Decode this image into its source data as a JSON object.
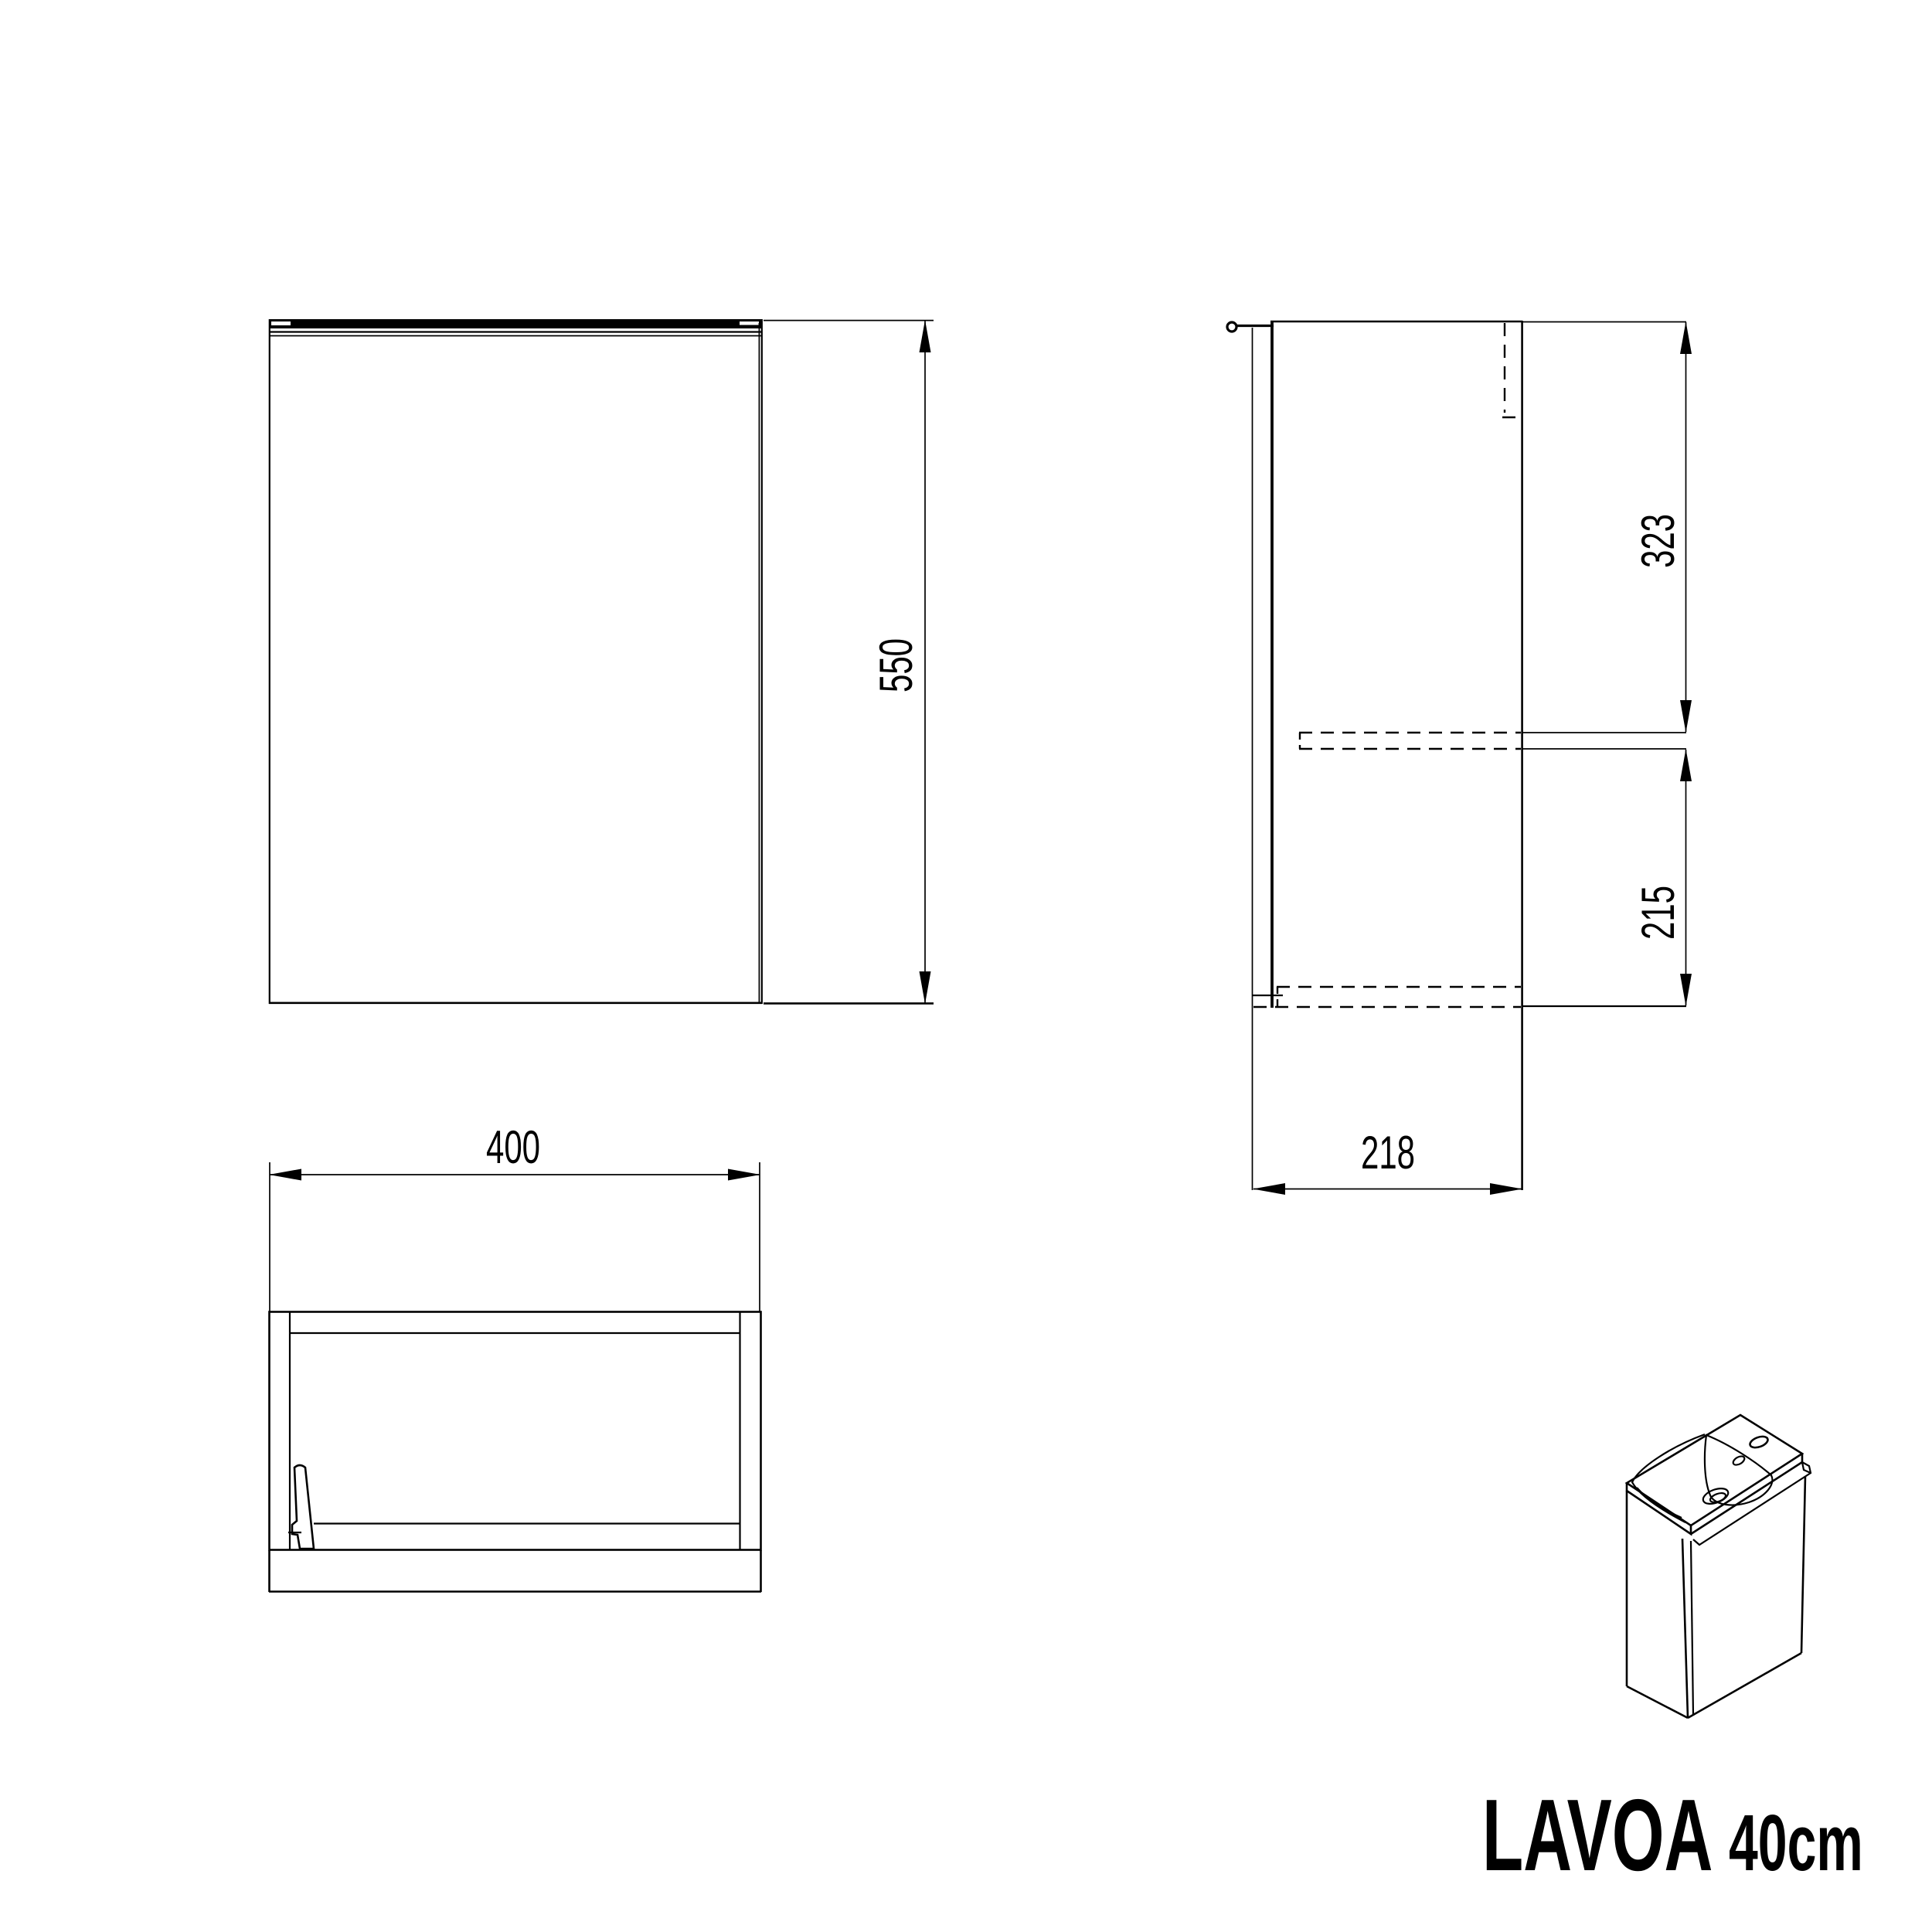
{
  "colors": {
    "line": "#000000",
    "background": "#ffffff"
  },
  "title": {
    "name": "LAVOA",
    "size": "40cm"
  },
  "dimensions": {
    "front_height": "550",
    "side_top_section": "323",
    "side_bottom_section": "215",
    "side_depth": "218",
    "top_width": "400"
  }
}
